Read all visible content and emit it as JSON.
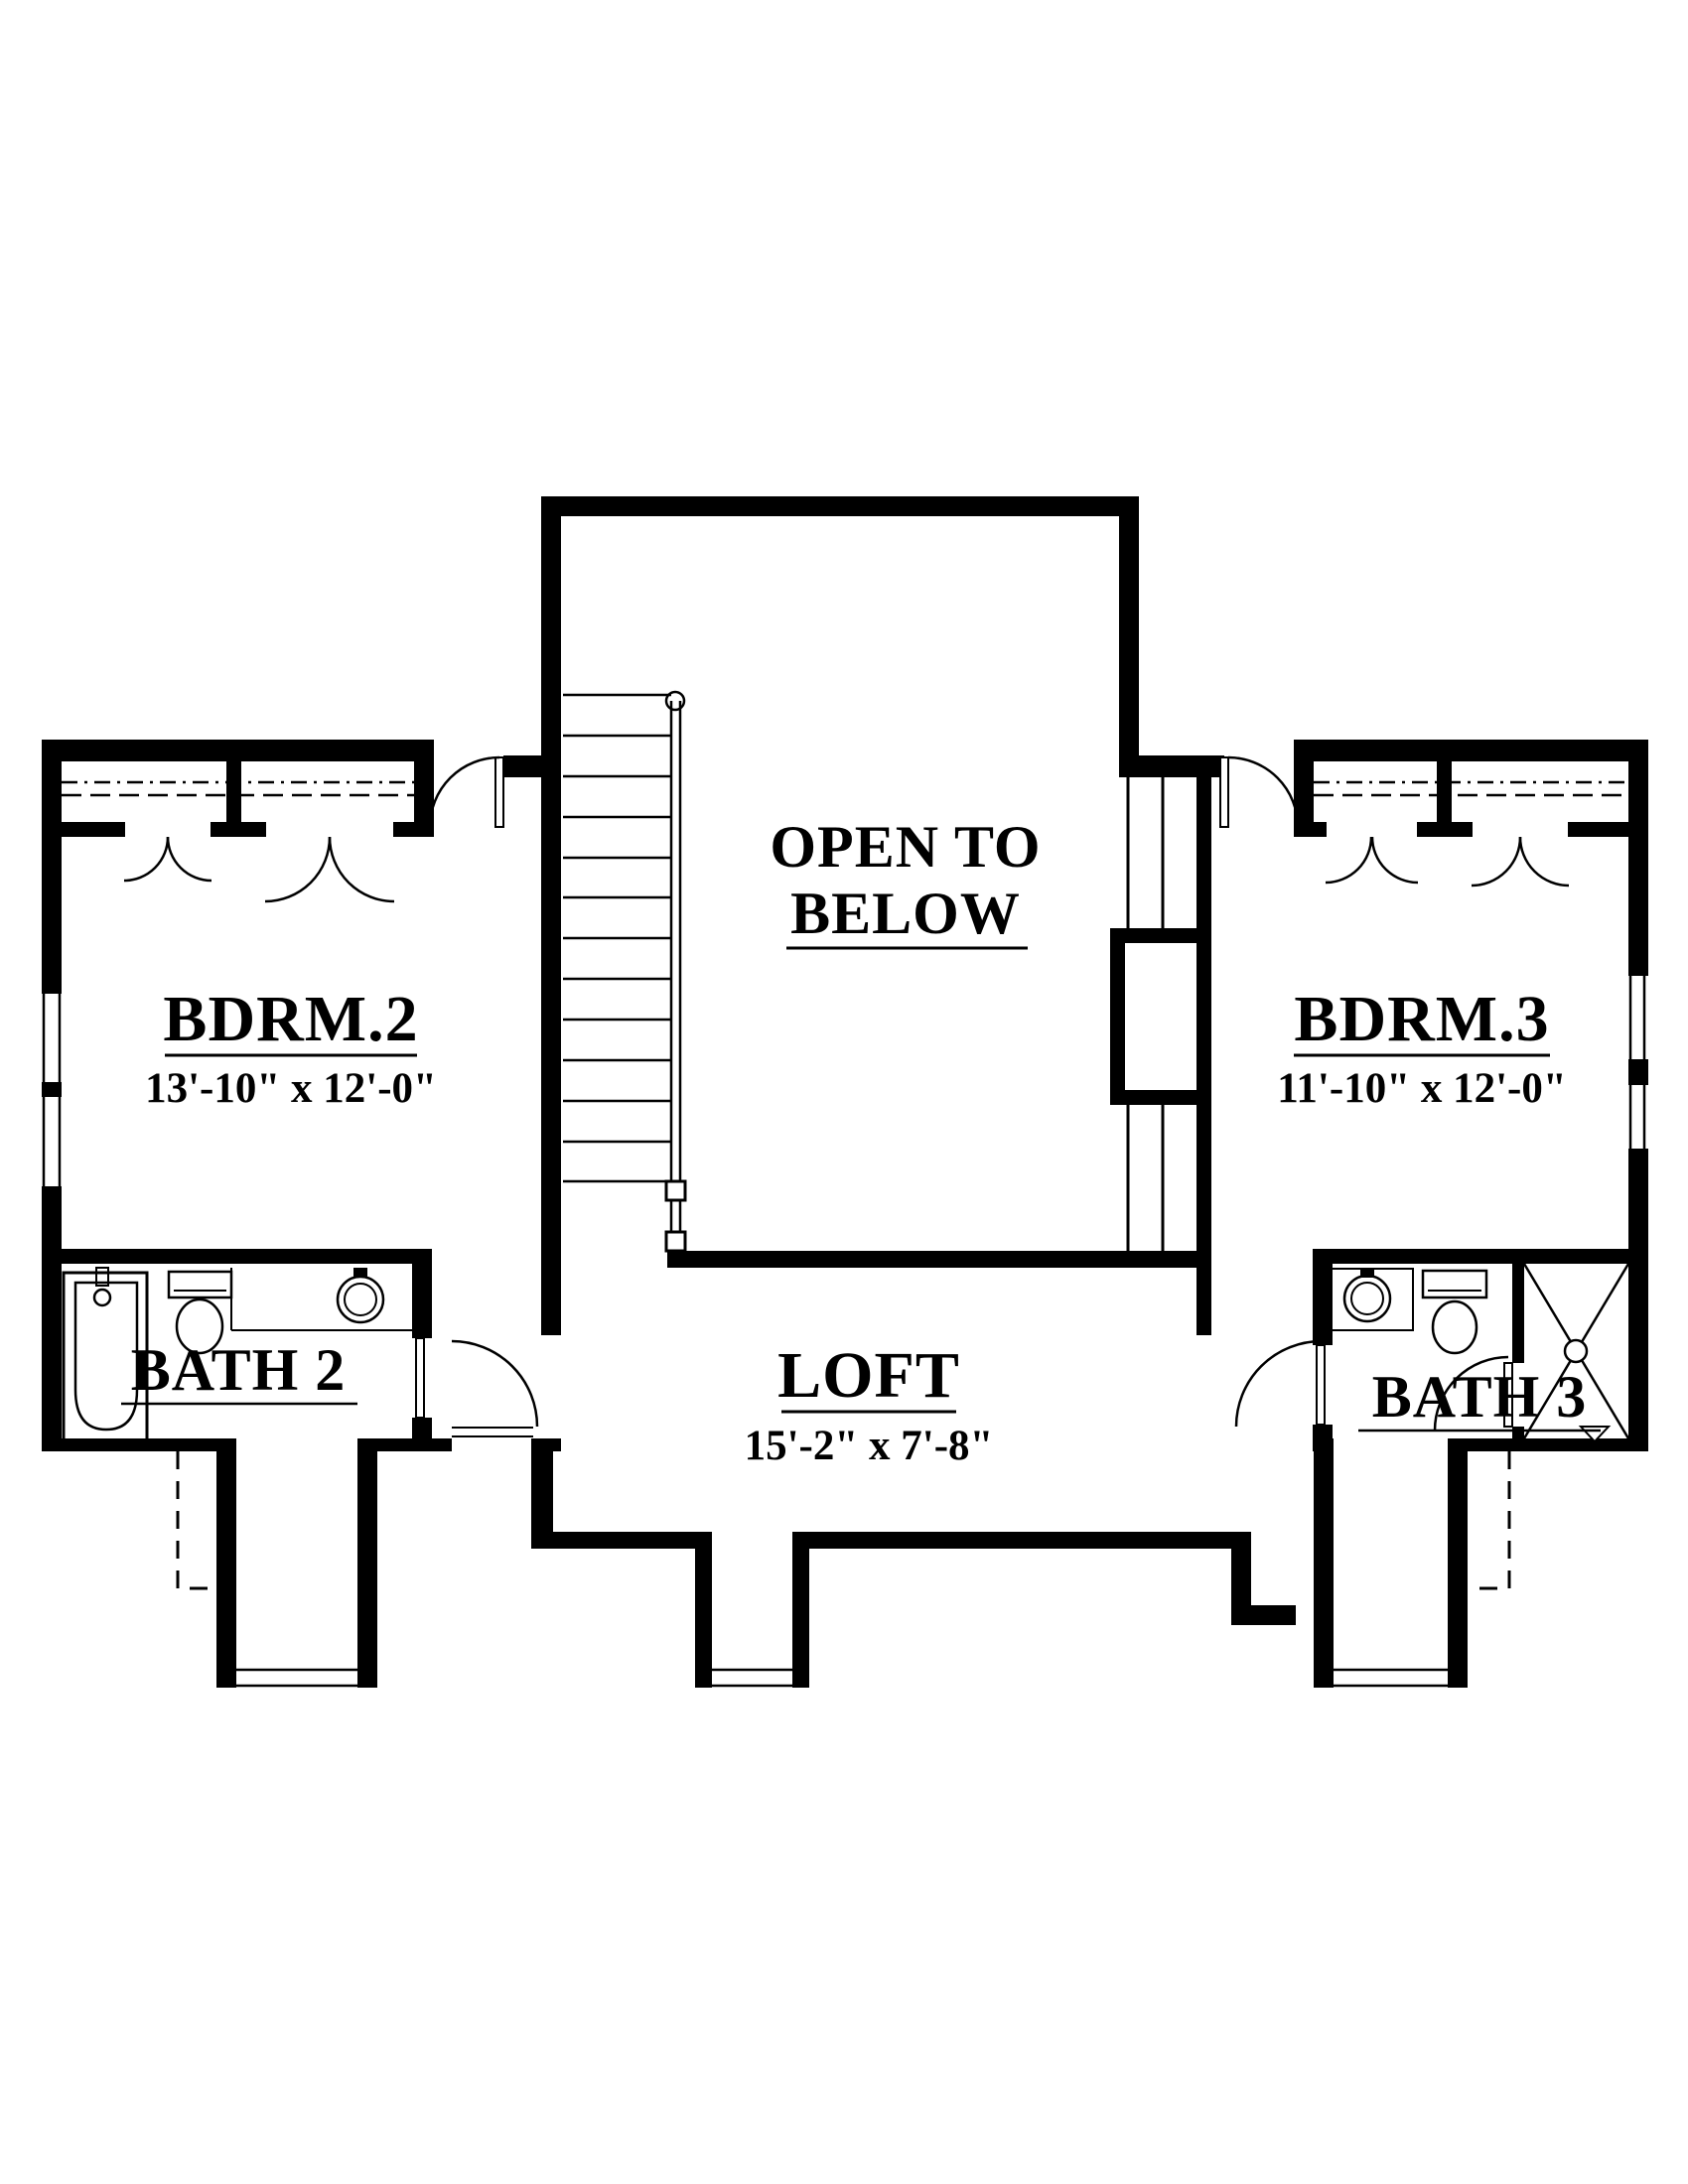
{
  "plan": {
    "rooms": {
      "bdrm2": {
        "label": "BDRM.2",
        "dims": "13'-10\" x 12'-0\""
      },
      "bdrm3": {
        "label": "BDRM.3",
        "dims": "11'-10\" x 12'-0\""
      },
      "loft": {
        "label": "LOFT",
        "dims": "15'-2\" x 7'-8\""
      },
      "bath2": {
        "label": "BATH 2"
      },
      "bath3": {
        "label": "BATH 3"
      },
      "open_to_below": {
        "line1": "OPEN TO",
        "line2": "BELOW"
      }
    },
    "colors": {
      "line": "#000000",
      "background": "#ffffff"
    }
  }
}
